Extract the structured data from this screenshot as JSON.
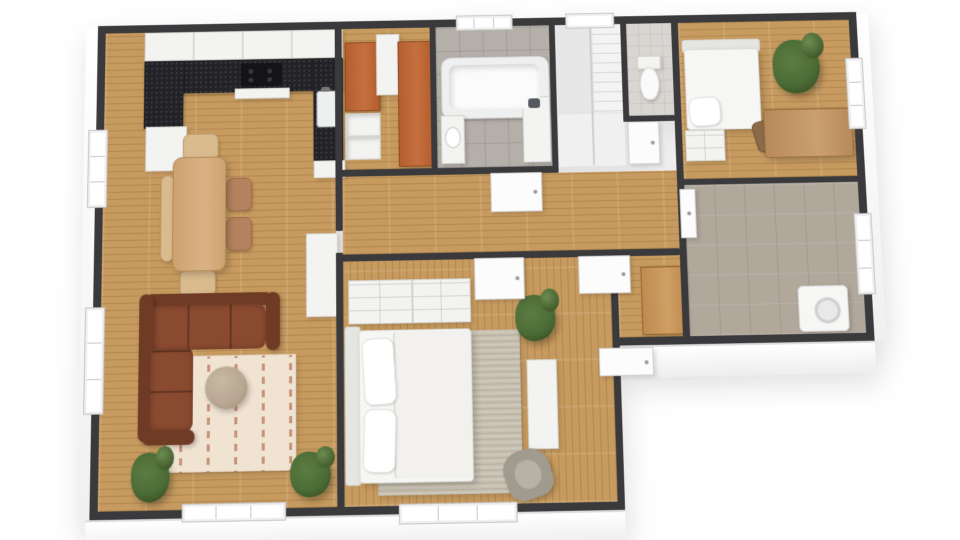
{
  "scene": {
    "kind": "3d-floor-plan-render",
    "background": "#ffffff",
    "palette": {
      "bg": "#ffffff",
      "wall": "#3a3a3c",
      "wallFace": "#f2f2f2",
      "fasciaTop": "#ffffff",
      "fasciaBottom": "#ededed",
      "floorWood": "#c79b5f",
      "tileBath": "#b4afa9",
      "tileUtility": "#b1a79b",
      "tileWc": "#d9d6d2",
      "counterDark": "#232327",
      "cabinetWhite": "#f3f3f1",
      "wardrobeOrange": "#b45e2f",
      "hallCabinetWood": "#bf8a50",
      "sofaBrown": "#8a4a30",
      "sofaBrownDark": "#703b24",
      "rugCream": "#f1e3d2",
      "rugAccent": "#b06a4b",
      "rugMaster": "#c7c0b0",
      "bedWhite": "#f6f6f4",
      "bedFrame": "#e5e5e2",
      "tableWood": "#cda270",
      "chairWood": "#d9bb8e",
      "chairSeat": "#b5825f",
      "deskWood": "#b8895b",
      "deskChairWood": "#8a6b4a",
      "coffeeTable": "#b6a692",
      "armchairGray": "#a19a8f",
      "plantGreen": "#4c6c36",
      "plantDark": "#33491f",
      "applianceWhite": "#f6f6f5",
      "doorWhite": "#fcfcfc",
      "doorEdge": "#d2d2d2",
      "windowFrame": "#c6c6c6"
    },
    "rooms": [
      {
        "id": "kitchen-dining",
        "floor": "wood",
        "items": [
          "upper-cabinets",
          "countertop",
          "cooktop",
          "kitchen-sink",
          "base-cabinets",
          "dining-table",
          "dining-chairs",
          "dining-bench"
        ]
      },
      {
        "id": "living-area",
        "floor": "wood",
        "items": [
          "corner-sofa",
          "area-rug",
          "coffee-table",
          "tall-cabinet",
          "potted-plants"
        ]
      },
      {
        "id": "pantry-closet",
        "floor": "wood",
        "items": [
          "orange-wardrobes",
          "shelf-unit",
          "open-shelves"
        ]
      },
      {
        "id": "bathroom",
        "floor": "tile",
        "items": [
          "bathtub",
          "washbasin",
          "shower-column",
          "window"
        ]
      },
      {
        "id": "staircase",
        "floor": "hard",
        "items": [
          "stair-flight",
          "landing",
          "window"
        ]
      },
      {
        "id": "wc",
        "floor": "tile",
        "items": [
          "toilet",
          "door"
        ]
      },
      {
        "id": "bedroom-small",
        "floor": "wood",
        "items": [
          "single-bed",
          "pillow",
          "chest-of-drawers",
          "desk",
          "desk-chair",
          "potted-plant",
          "window"
        ]
      },
      {
        "id": "utility-room",
        "floor": "tile",
        "items": [
          "washing-machine",
          "door",
          "window"
        ]
      },
      {
        "id": "hallway",
        "floor": "wood",
        "items": [
          "bathroom-door",
          "bedroom-door"
        ]
      },
      {
        "id": "entry-hall",
        "floor": "wood",
        "items": [
          "wardrobe-cabinet",
          "hall-door",
          "entry-door"
        ]
      },
      {
        "id": "bedroom-master",
        "floor": "wood",
        "items": [
          "double-bed",
          "pillows",
          "dressers",
          "area-rug",
          "armchair",
          "sideboard",
          "potted-plant",
          "window"
        ]
      }
    ]
  }
}
